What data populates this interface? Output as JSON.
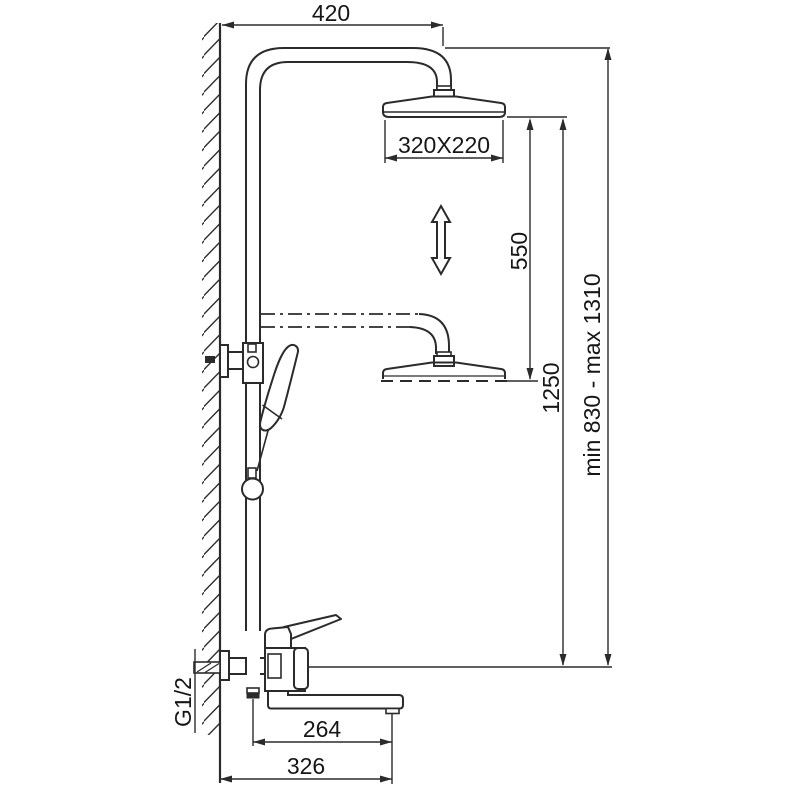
{
  "diagram": {
    "type": "technical-dimension-drawing",
    "subject": "wall-mounted shower column with rain head, hand shower and bath spout mixer",
    "units": "mm",
    "dimensions": {
      "top_arm_offset": "420",
      "head_size": "320X220",
      "height_adjust_travel": "550",
      "column_height": "1250",
      "overall_height_range": "min 830 - max 1310",
      "inlet_thread": "G1/2",
      "spout_reach": "264",
      "overall_reach": "326"
    },
    "colors": {
      "line": "#2b2b2b",
      "text": "#161616",
      "background": "#ffffff"
    }
  }
}
